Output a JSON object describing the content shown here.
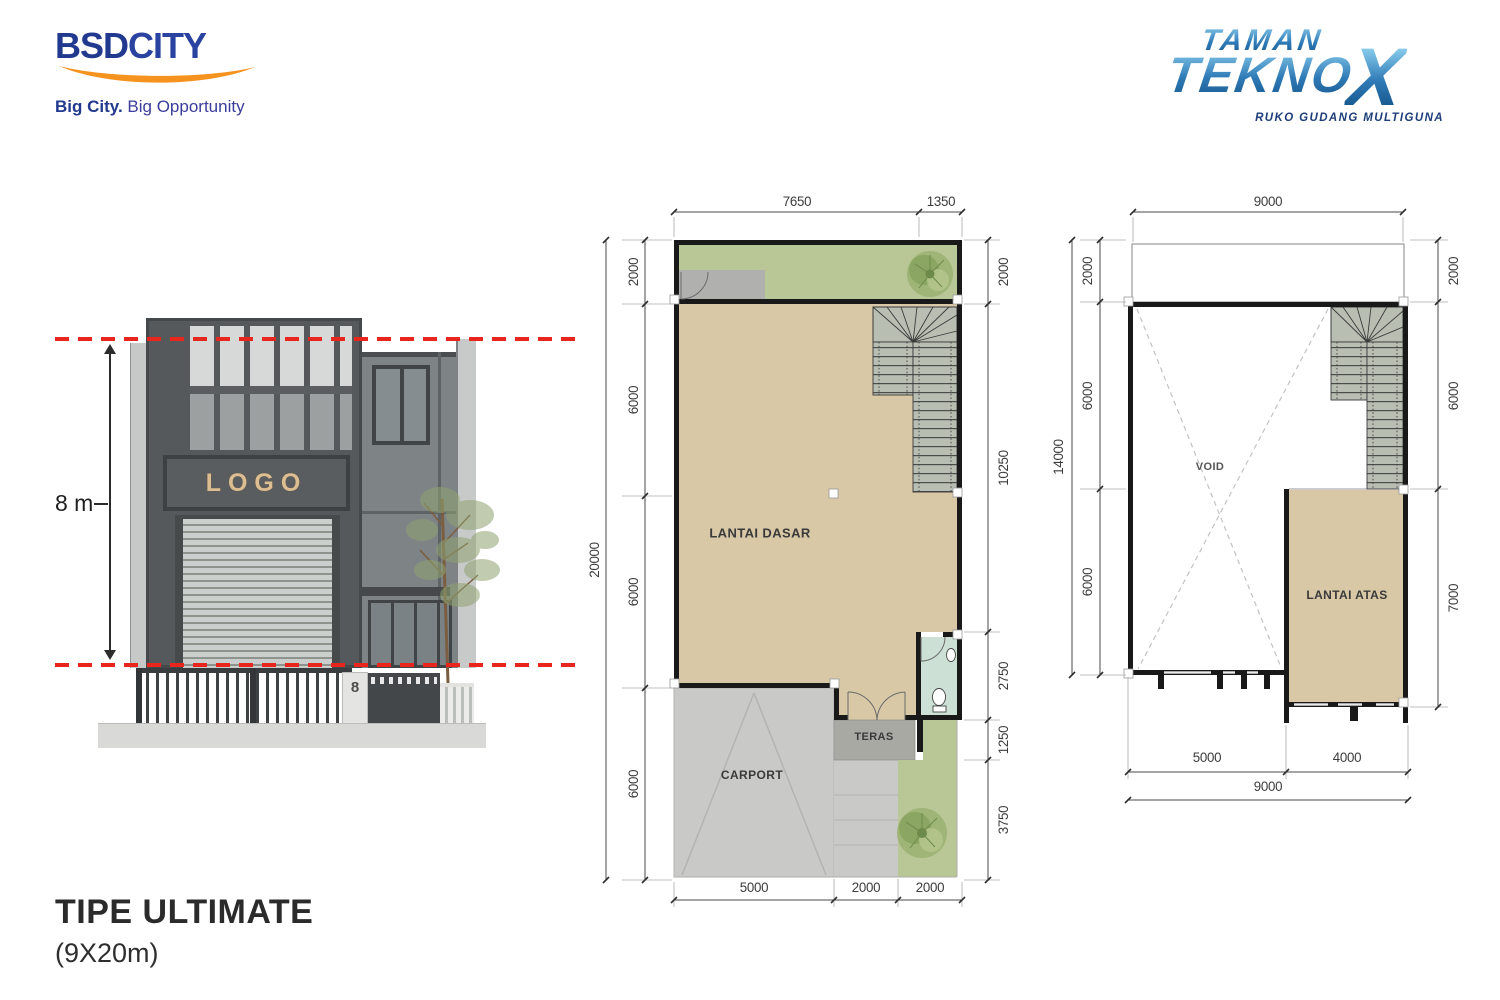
{
  "branding": {
    "bsd": {
      "name_bold": "BSD",
      "name_light": "CITY",
      "tagline_bold": "Big City.",
      "tagline_light": " Big Opportunity"
    },
    "tekno": {
      "line1": "TAMAN",
      "line2": "TEKNO",
      "x": "X",
      "tagline": "RUKO GUDANG MULTIGUNA"
    }
  },
  "title": {
    "main": "TIPE ULTIMATE",
    "sub": "(9X20m)"
  },
  "elevation": {
    "height_label": "8 m",
    "logo_text": "LOGO",
    "house_number": "8"
  },
  "plans": {
    "ground": {
      "name": "LANTAI DASAR",
      "rooms": {
        "main": "LANTAI DASAR",
        "carport": "CARPORT",
        "teras": "TERAS"
      },
      "dims": {
        "top": [
          "7650",
          "1350"
        ],
        "left_total": "20000",
        "left": [
          "2000",
          "6000",
          "6000",
          "6000"
        ],
        "right": [
          "2000",
          "10250",
          "2750",
          "1250",
          "3750"
        ],
        "bottom": [
          "5000",
          "2000",
          "2000"
        ]
      }
    },
    "upper": {
      "name": "LANTAI ATAS",
      "rooms": {
        "void": "VOID",
        "main": "LANTAI ATAS"
      },
      "dims": {
        "top": [
          "9000"
        ],
        "left_total": "14000",
        "left": [
          "2000",
          "6000",
          "6000"
        ],
        "right": [
          "2000",
          "6000",
          "7000"
        ],
        "bottom": [
          "5000",
          "4000"
        ],
        "bottom_total": "9000"
      }
    }
  },
  "colors": {
    "accent_red": "#E8261D",
    "bsd_blue": "#21398E",
    "bsd_orange": "#F6921E",
    "tekno_blue_dark": "#16548A",
    "tekno_blue_light": "#8FD1F0",
    "wall_black": "#191919",
    "floor_beige": "#D8C8A6",
    "garden_green": "#B8C795",
    "carport_gray": "#C9C9C7",
    "teras_gray": "#A8A9A2",
    "bath_green": "#CDE0D5",
    "stair_gray": "#B9BEB3",
    "facade_gray": "#56595B",
    "title_text": "#2B2B2B"
  }
}
